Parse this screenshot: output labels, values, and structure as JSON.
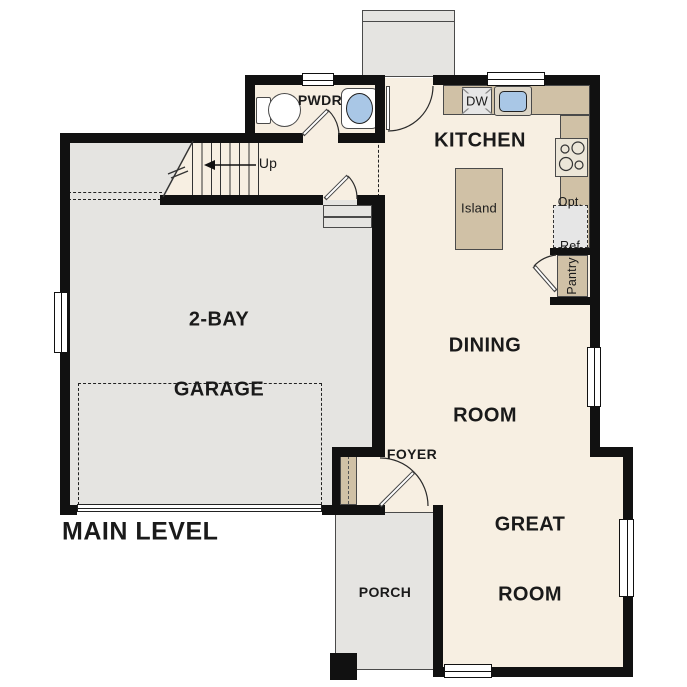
{
  "plan_title": "MAIN LEVEL",
  "colors": {
    "wall": "#111111",
    "floor": "#f7efe2",
    "concrete": "#e5e4e1",
    "counter": "#d0c1a6",
    "sink_blue": "#a9c7e6",
    "appliance": "#e6e6e6",
    "outline": "#4a4a4a",
    "text": "#1a1a1a"
  },
  "labels": {
    "pwdr": "PWDR",
    "kitchen": "KITCHEN",
    "island": "Island",
    "dishwasher": "DW",
    "opt_ref_line1": "Opt.",
    "opt_ref_line2": "Ref",
    "pantry": "Pantry",
    "dining_line1": "DINING",
    "dining_line2": "ROOM",
    "great_line1": "GREAT",
    "great_line2": "ROOM",
    "garage_line1": "2-BAY",
    "garage_line2": "GARAGE",
    "foyer": "FOYER",
    "porch": "PORCH",
    "stairs_up": "Up",
    "level": "MAIN LEVEL"
  }
}
